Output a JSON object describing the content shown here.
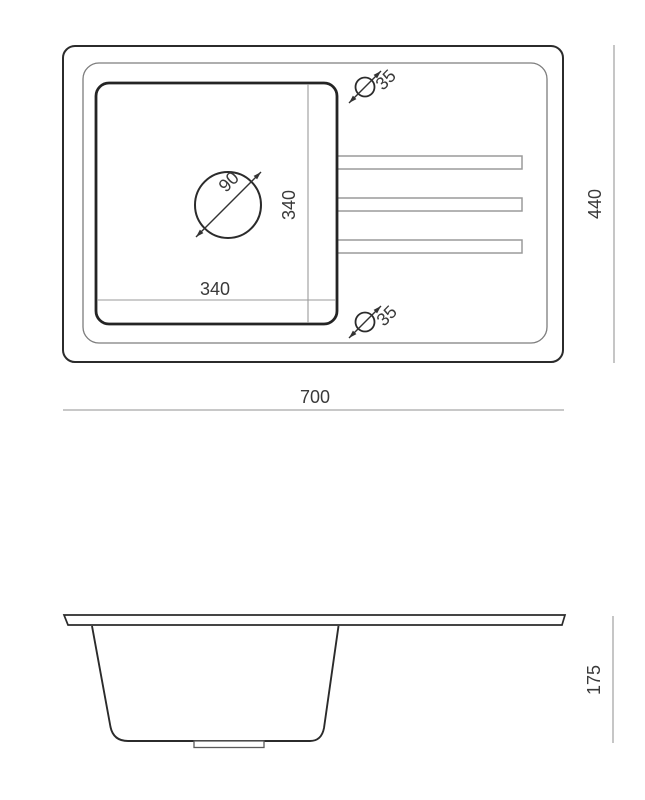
{
  "drawing": {
    "background": "#ffffff",
    "line_colors": {
      "primary_outline": "#2b2b2b",
      "secondary_outline": "#7d7d7d",
      "groove_outline": "#9a9a9a",
      "dimension_line": "#a8a8a8",
      "label_text": "#3a3a3a"
    },
    "top_view": {
      "overall_width": "700",
      "overall_height": "440",
      "basin_width": "340",
      "basin_height": "340",
      "drain_diameter": "90",
      "faucet_hole_top_diameter": "35",
      "faucet_hole_bottom_diameter": "35"
    },
    "side_view": {
      "depth": "175"
    }
  }
}
